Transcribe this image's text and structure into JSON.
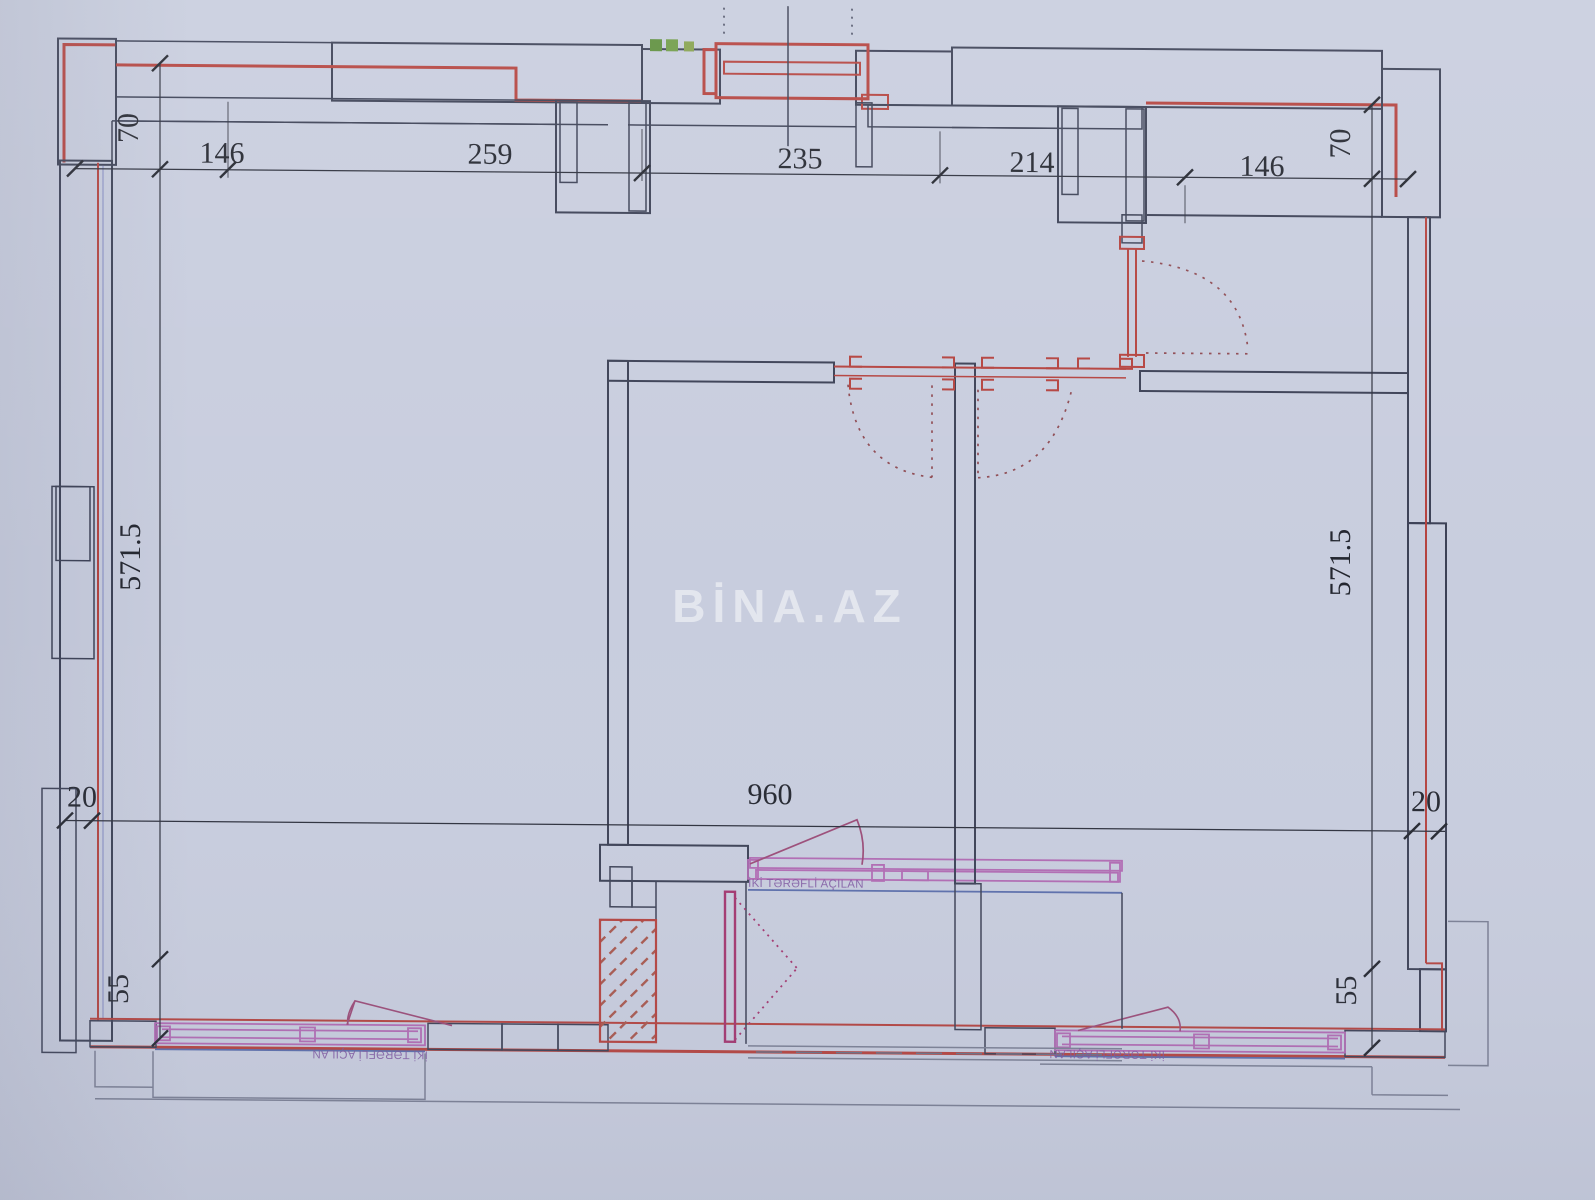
{
  "watermark": "BİNA.AZ",
  "dimensions": {
    "top": {
      "offset_left": "70",
      "w1": "146",
      "w2": "259",
      "w3": "235",
      "w4": "214",
      "w5": "146",
      "offset_right": "70"
    },
    "left": {
      "height": "571.5",
      "inset": "20",
      "parapet": "55"
    },
    "right": {
      "height": "571.5",
      "inset": "20",
      "parapet": "55"
    },
    "bottom": {
      "total_width": "960"
    }
  },
  "window_labels": {
    "balcony_center": "İKİ TƏRƏFLİ AÇILAN",
    "bottom_left": "İKİ TƏRƏFLİ AÇILAN",
    "bottom_right": "İKİ TƏRƏFLİ AÇILAN"
  },
  "colors": {
    "paper": "#c8cdde",
    "ink": "#3b4055",
    "wall_red": "#b4423e",
    "hatch_red": "#c2685e",
    "insulation_blue": "#5a6dab",
    "balcony_green": "#79a352",
    "partition_purple": "#8474ad",
    "window_frame": "#b16ab3",
    "door_magenta": "#a3356e",
    "dimension_text": "#23262f",
    "watermark": "#ffffff"
  }
}
